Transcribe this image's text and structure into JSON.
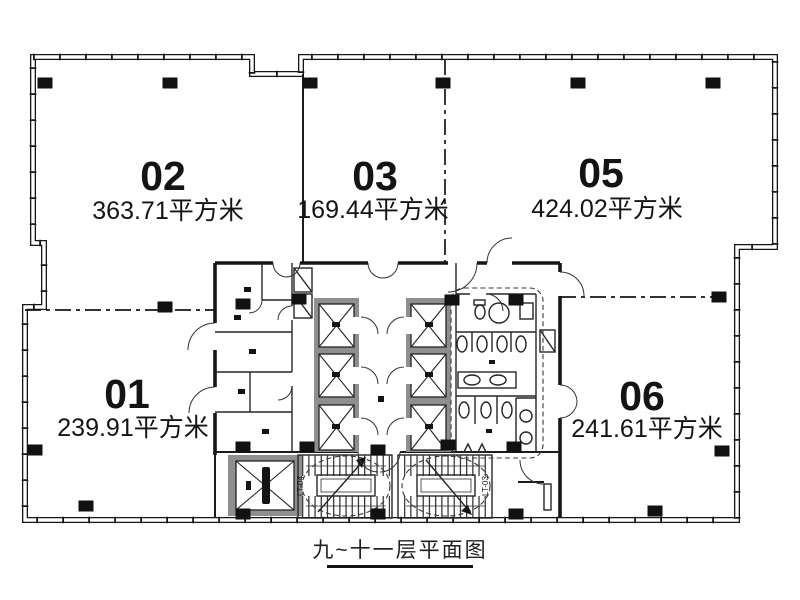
{
  "drawing": {
    "caption": "九~十一层平面图",
    "units": [
      {
        "id": "01",
        "area": "239.91平方米"
      },
      {
        "id": "02",
        "area": "363.71平方米"
      },
      {
        "id": "03",
        "area": "169.44平方米"
      },
      {
        "id": "05",
        "area": "424.02平方米"
      },
      {
        "id": "06",
        "area": "241.61平方米"
      }
    ],
    "stairs": [
      {
        "label": "LT-04"
      },
      {
        "label": "LT-03"
      }
    ],
    "colors": {
      "ink": "#141414",
      "paper": "#ffffff",
      "shaft_gray": "#8f8f8f"
    }
  }
}
